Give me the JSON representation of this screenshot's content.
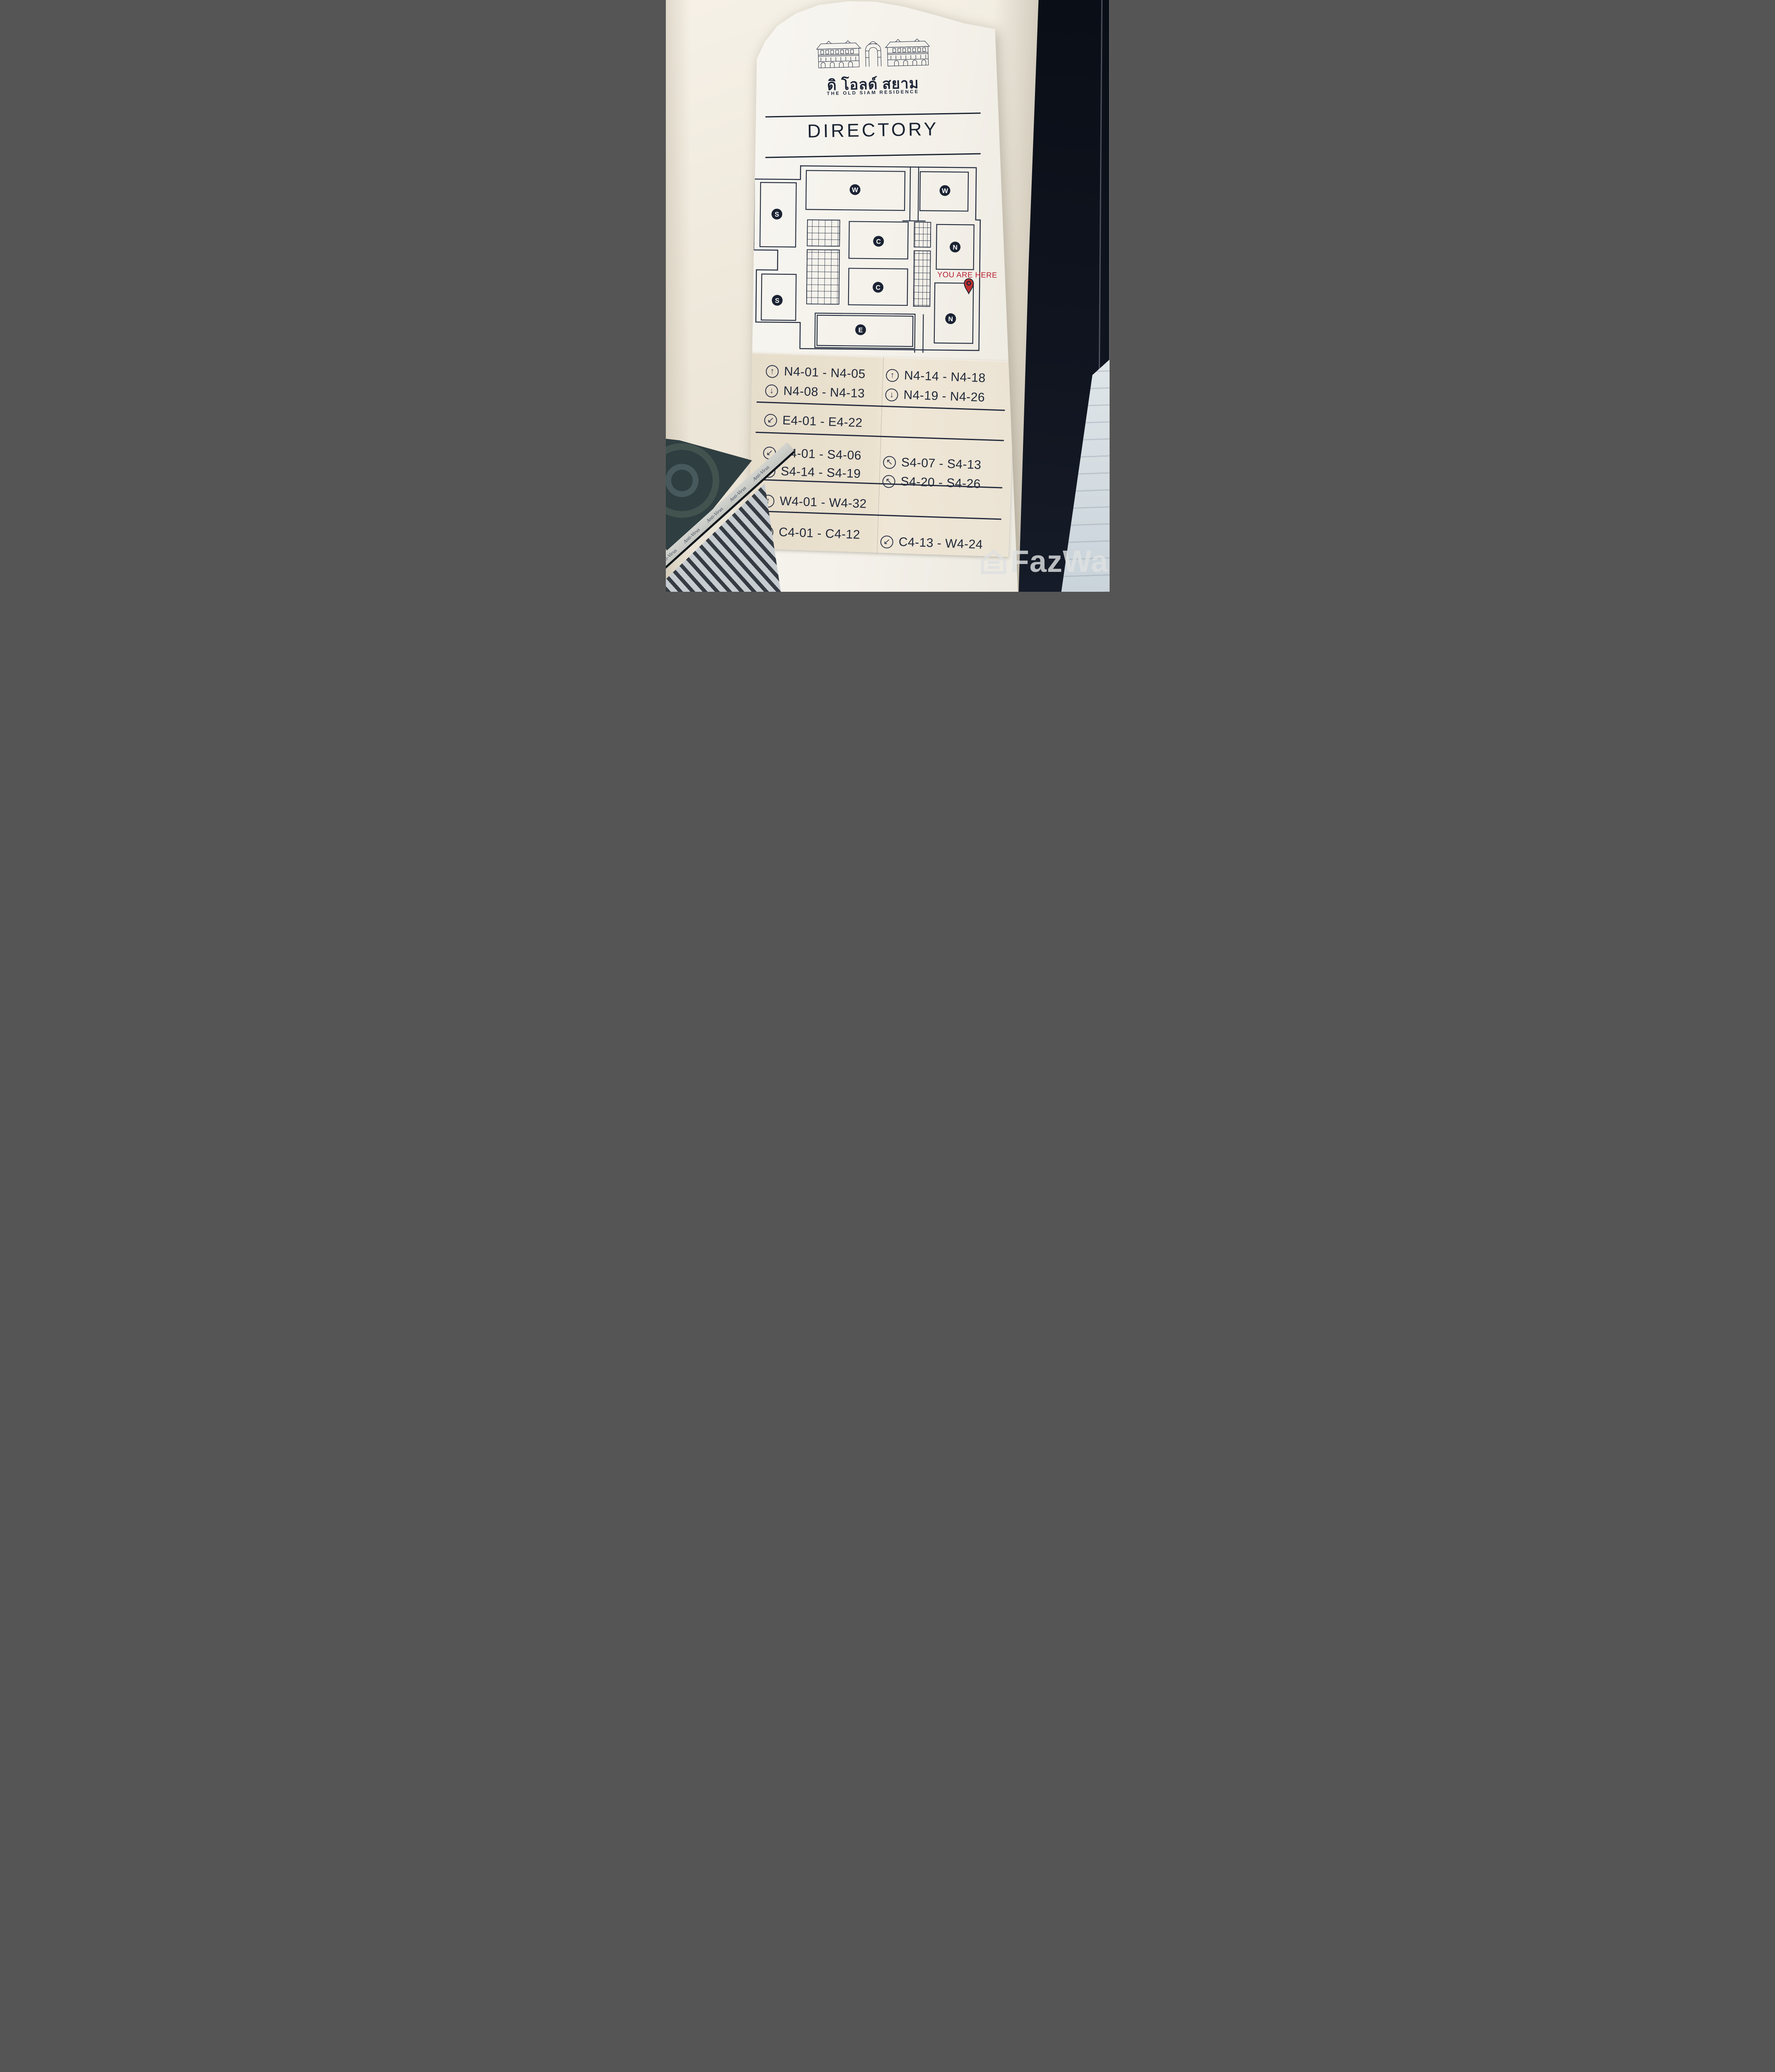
{
  "sign": {
    "brand": {
      "name_thai": "ดิ โอลด์ สยาม",
      "name_en": "THE OLD SIAM RESIDENCE"
    },
    "heading": "DIRECTORY",
    "map": {
      "you_are_here_label": "YOU ARE HERE",
      "zones": [
        {
          "label": "W"
        },
        {
          "label": "W"
        },
        {
          "label": "S"
        },
        {
          "label": "C"
        },
        {
          "label": "N"
        },
        {
          "label": "S"
        },
        {
          "label": "C"
        },
        {
          "label": "N"
        },
        {
          "label": "E"
        }
      ]
    },
    "directory": {
      "left": [
        {
          "icon": "↑",
          "icon_name": "arrow-up",
          "label": "N4-01 - N4-05"
        },
        {
          "icon": "↓",
          "icon_name": "arrow-down",
          "label": "N4-08 - N4-13"
        },
        {
          "icon": "↙",
          "icon_name": "arrow-down-left",
          "label": "E4-01 - E4-22"
        },
        {
          "icon": "↙",
          "icon_name": "arrow-down-left",
          "label": "S4-01 - S4-06"
        },
        {
          "icon": "↙",
          "icon_name": "arrow-down-left",
          "label": "S4-14 - S4-19"
        },
        {
          "icon": "↑",
          "icon_name": "arrow-up",
          "label": "W4-01 - W4-32"
        },
        {
          "icon": "↖",
          "icon_name": "arrow-up-left",
          "label": "C4-01 - C4-12"
        }
      ],
      "right": [
        {
          "icon": "↑",
          "icon_name": "arrow-up",
          "label": "N4-14 - N4-18"
        },
        {
          "icon": "↓",
          "icon_name": "arrow-down",
          "label": "N4-19 - N4-26"
        },
        {
          "icon": "↖",
          "icon_name": "arrow-up-left",
          "label": "S4-07 - S4-13"
        },
        {
          "icon": "↖",
          "icon_name": "arrow-up-left",
          "label": "S4-20 - S4-26"
        },
        {
          "icon": "↙",
          "icon_name": "arrow-down-left",
          "label": "C4-13 - W4-24"
        }
      ]
    }
  },
  "environment": {
    "film_label": "Anti-Virus"
  },
  "watermark": {
    "text": "FazWaz"
  },
  "colors": {
    "accent_red": "#b41f30",
    "line_navy": "#222b3d",
    "panel_tan": "#e9e1d1",
    "sign_white": "#f5f3ed"
  }
}
